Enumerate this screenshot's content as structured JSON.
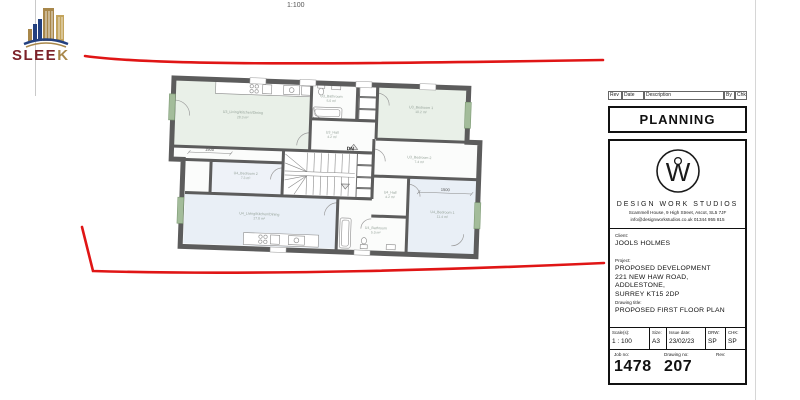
{
  "page": {
    "scale_note": "1:100"
  },
  "logo": {
    "text_main": "SLEE",
    "text_accent": "K"
  },
  "plan": {
    "dn": "DN",
    "dim1": "1500",
    "dim2": "1500",
    "rooms": [
      {
        "name": "U3_Living/Kitchen/Dining",
        "area": "28.3 m²"
      },
      {
        "name": "U3_Bathroom",
        "area": "5.0 m²"
      },
      {
        "name": "U3_Bedroom 1",
        "area": "10.2 m²"
      },
      {
        "name": "U3_Hall",
        "area": "4.2 m²"
      },
      {
        "name": "U3_Bedroom 2",
        "area": "7.4 m²"
      },
      {
        "name": "U4_Bedroom 2",
        "area": "7.3 m²"
      },
      {
        "name": "U4_Living/Kitchen/Dining",
        "area": "27.8 m²"
      },
      {
        "name": "U4_Hall",
        "area": "4.2 m²"
      },
      {
        "name": "U4_Bathroom",
        "area": "5.0 m²"
      },
      {
        "name": "U4_Bedroom 1",
        "area": "11.4 m²"
      }
    ]
  },
  "titleblock": {
    "rev_header": {
      "rev": "Rev",
      "date": "Date",
      "description": "Description",
      "by": "By",
      "chk": "Chk"
    },
    "status": "PLANNING",
    "studio": {
      "logo_letter": "W",
      "name": "DESIGN WORK STUDIOS",
      "address": "Scammell House, 9 High Street, Ascot, SL5 7JF",
      "contact": "info@designworkstudios.co.uk 01344 955 815"
    },
    "client_label": "Client:",
    "client": "JOOLS HOLMES",
    "project_label": "Project:",
    "project_lines": [
      "PROPOSED DEVELOPMENT",
      "221 NEW HAW ROAD, ADDLESTONE,",
      "SURREY KT15 2DP"
    ],
    "drawing_title_label": "Drawing title:",
    "drawing_title": "PROPOSED FIRST FLOOR PLAN",
    "meta": {
      "scale_label": "Scale(s):",
      "scale": "1 : 100",
      "size_label": "Size:",
      "size": "A3",
      "issue_label": "Issue date:",
      "issue": "23/02/23",
      "drw_label": "DRW:",
      "drw": "SP",
      "chk_label": "CHK:",
      "chk": "SP"
    },
    "footer": {
      "job_label": "Job no:",
      "job": "1478",
      "dwg_label": "Drawing no:",
      "dwg": "207",
      "rev_label": "Rev:"
    }
  },
  "colors": {
    "annotation_red": "#e01515",
    "wall_gray": "#5c5c5c",
    "unit3_fill": "#e9f0e8",
    "unit4_fill": "#e9eff6",
    "window_green": "#a3bc9a",
    "logo_navy": "#23407f",
    "logo_gold": "#a8874a",
    "logo_maroon": "#7c2129"
  }
}
